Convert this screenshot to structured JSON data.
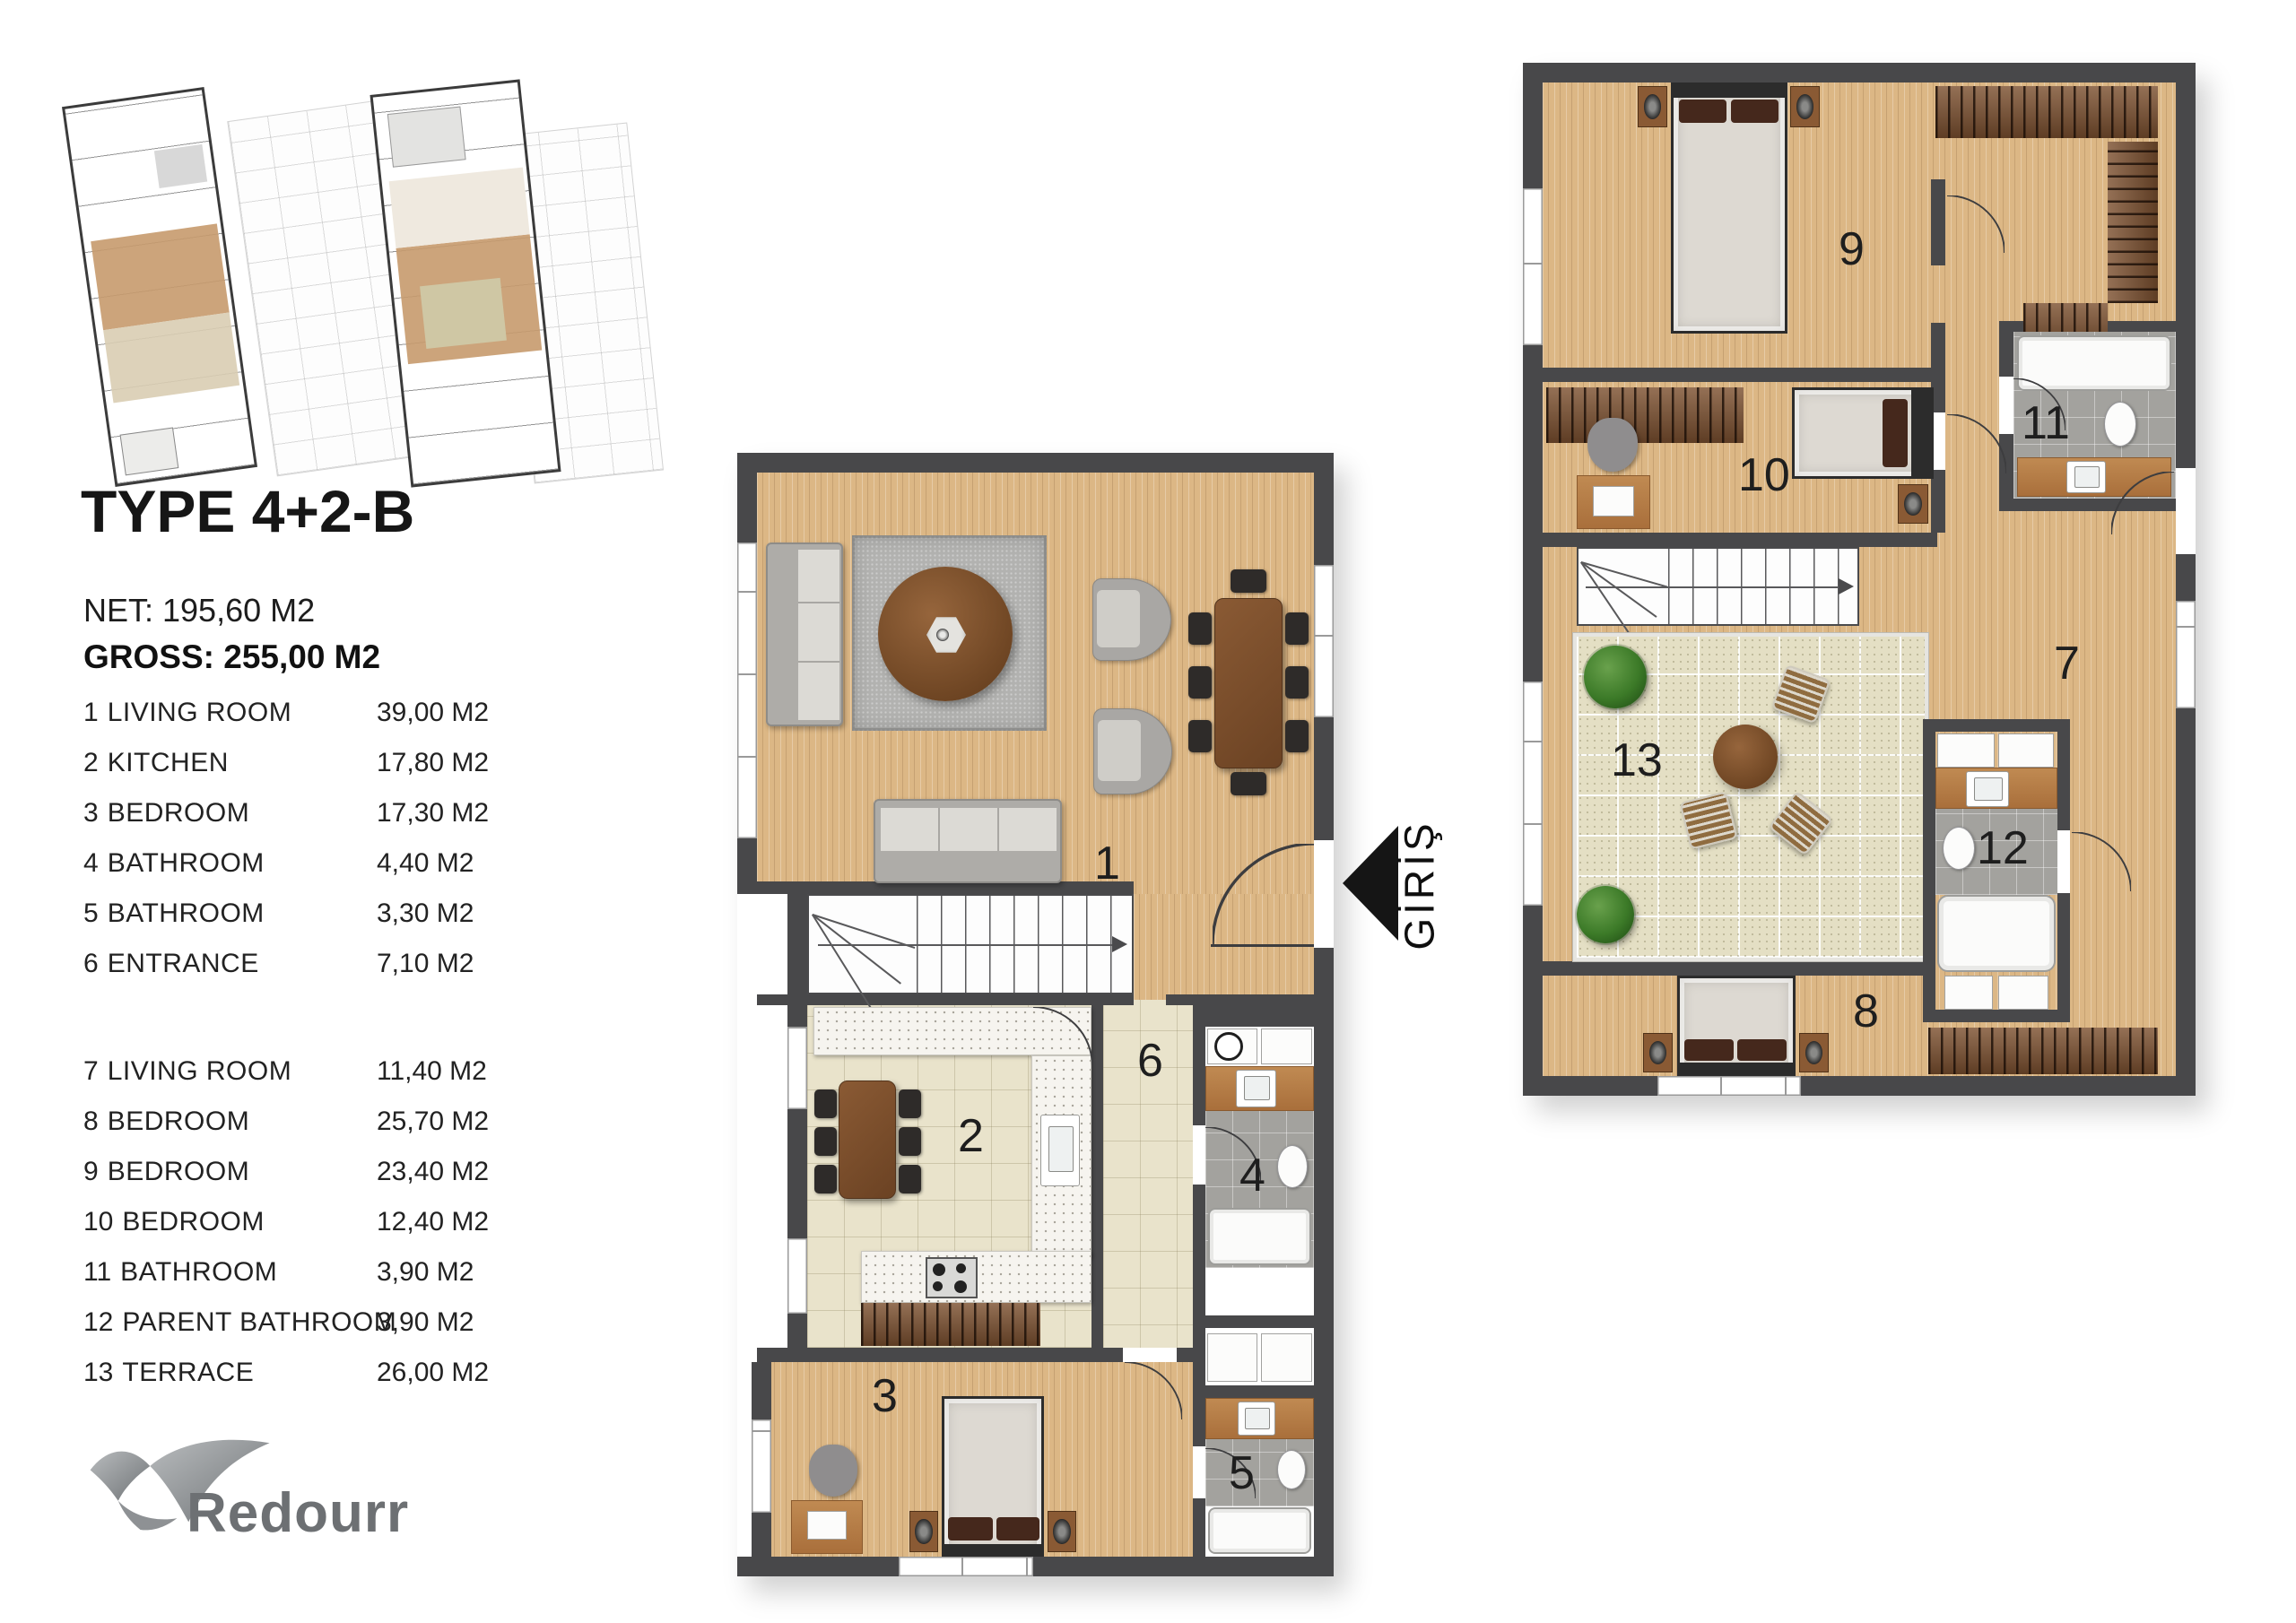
{
  "header": {
    "title": "TYPE 4+2-B",
    "net": "NET: 195,60 M2",
    "gross": "GROSS: 255,00 M2"
  },
  "rooms_lower": [
    {
      "num": "1",
      "name": "LIVING ROOM",
      "area": "39,00 M2"
    },
    {
      "num": "2",
      "name": "KITCHEN",
      "area": "17,80 M2"
    },
    {
      "num": "3",
      "name": "BEDROOM",
      "area": "17,30 M2"
    },
    {
      "num": "4",
      "name": "BATHROOM",
      "area": "4,40 M2"
    },
    {
      "num": "5",
      "name": "BATHROOM",
      "area": "3,30 M2"
    },
    {
      "num": "6",
      "name": "ENTRANCE",
      "area": "7,10 M2"
    }
  ],
  "rooms_upper": [
    {
      "num": "7",
      "name": "LIVING ROOM",
      "area": "11,40 M2"
    },
    {
      "num": "8",
      "name": "BEDROOM",
      "area": "25,70 M2"
    },
    {
      "num": "9",
      "name": "BEDROOM",
      "area": "23,40 M2"
    },
    {
      "num": "10",
      "name": "BEDROOM",
      "area": "12,40 M2"
    },
    {
      "num": "11",
      "name": "BATHROOM",
      "area": "3,90 M2"
    },
    {
      "num": "12",
      "name": "PARENT BATHROOM",
      "area": "3,90 M2"
    },
    {
      "num": "13",
      "name": "TERRACE",
      "area": "26,00 M2"
    }
  ],
  "entrance": {
    "label": "GİRİŞ"
  },
  "brand": {
    "name": "Redourr"
  },
  "colors": {
    "wall": "#48484a",
    "wood_floor": "#dcb785",
    "tile_floor": "#e9e3cb",
    "terrace_floor": "#e4dfc4",
    "bath_floor": "#a3a29e",
    "rug": "#b2b2b0",
    "chair_dark": "#2e2b29",
    "mattress": "#ddd9d2",
    "headboard": "#45281c",
    "brand_gray": "#6d7073",
    "text": "#1c1c1c"
  }
}
